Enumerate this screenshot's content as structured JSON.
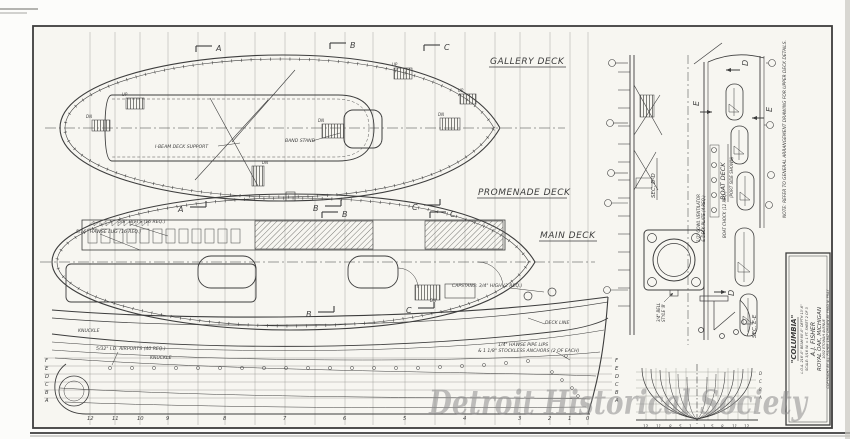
{
  "watermark": "Detroit Historical Society",
  "decks": {
    "gallery": "GALLERY DECK",
    "promenade": "PROMENADE DECK",
    "main": "MAIN DECK",
    "boat": "BOAT DECK",
    "boat_sub": "(PORT SIDE SHOWN)"
  },
  "sections": {
    "a": "A",
    "b": "B",
    "c": "C",
    "d": "D",
    "e": "E",
    "sec_dd": "SEC. D-D",
    "sec_ee": "SEC. E-E"
  },
  "stairs": {
    "up": "UP",
    "dn": "DN"
  },
  "annotations": {
    "i_beam": "I-BEAM DECK SUPPORT",
    "band_stand": "BAND STAND",
    "bitts": "5/8\" BITTS (16 REQ.)",
    "hawse_lug": "5/16\" HAWSE LUG (16 REQ.)",
    "capstans": "CAPSTANS: 3/4\" HIGH (2 REQ.)",
    "deck_line": "DECK LINE",
    "knuckle": "KNUCKLE",
    "airports": "5/32\" I.D. AIRPORTS (40 REQ.)",
    "hawse_pipe_1": "1/4\" HAWSE PIPE LIPS",
    "hawse_pipe_2": "& 1 1/8\" STOCKLESS ANCHORS (2 OF EACH)",
    "bell_1": "3/4\" BELL",
    "bell_2": "STYLE 'B'",
    "cowl_1": "1/2\" COWL VENTILATOR",
    "cowl_2": "& DECK PLATE (4 REQ.)",
    "boat_chock": "BOAT CHOCK (12 REQ.)",
    "note": "NOTE: REFER TO GENERAL ARRANGEMENT DRAWING FOR UPPER DECK DETAILS."
  },
  "stations": [
    "12",
    "11",
    "10",
    "9",
    "8",
    "7",
    "6",
    "5",
    "4",
    "3",
    "2",
    "1",
    "0"
  ],
  "waterlines": [
    "F",
    "E",
    "D",
    "C",
    "B",
    "A"
  ],
  "bodyplan_right": [
    "D",
    "C",
    "B",
    "A"
  ],
  "bodyplan_stations_left": [
    "12",
    "11",
    "8",
    "5",
    "1"
  ],
  "bodyplan_stations_right": [
    "1",
    "5",
    "8",
    "11",
    "12"
  ],
  "title_block": {
    "name": "\"COLUMBIA\"",
    "dims": "L.O.A. 216'-0\"  BEAM 60'-0\"  DEPTH 13'-6\"",
    "scale_line": "SCALE: 3/16 IN. = 1 FT.      SHEET 2 OF 3",
    "firm": "A.J. FISHER",
    "city": "ROYAL OAK, MICHIGAN",
    "address": "1002 ETOWAH AVENUE",
    "copyright": "COPYRIGHT BY A.J. FISHER 1947   DRAWN BY FRED N. PRAY"
  },
  "colors": {
    "ink": "#3d3d3d",
    "paper": "#f7f6f1",
    "watermark": "#8e8e8e"
  }
}
